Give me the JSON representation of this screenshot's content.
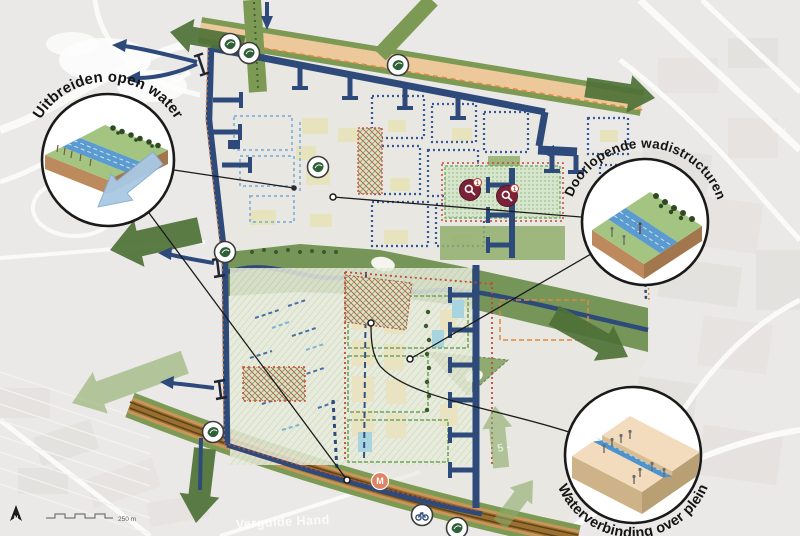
{
  "callouts": [
    {
      "id": "uitbreiden-open-water",
      "label": "Uitbreiden open water"
    },
    {
      "id": "doorlopende-wadistructuren",
      "label": "Doorlopende wadistructuren"
    },
    {
      "id": "waterverbinding-over-plein",
      "label": "Waterverbinding over plein"
    }
  ],
  "map": {
    "markers": [
      {
        "type": "water-icon",
        "x": 230,
        "y": 44
      },
      {
        "type": "water-icon",
        "x": 249,
        "y": 53
      },
      {
        "type": "water-icon",
        "x": 398,
        "y": 65
      },
      {
        "type": "water-icon",
        "x": 318,
        "y": 167
      },
      {
        "type": "water-icon",
        "x": 225,
        "y": 252
      },
      {
        "type": "water-icon",
        "x": 213,
        "y": 432
      },
      {
        "type": "water-icon",
        "x": 457,
        "y": 528
      },
      {
        "type": "transit-icon",
        "x": 422,
        "y": 515
      },
      {
        "type": "metro-station",
        "x": 380,
        "y": 481,
        "label": "M"
      },
      {
        "type": "attention",
        "x": 470,
        "y": 190,
        "badge": "1"
      },
      {
        "type": "attention",
        "x": 507,
        "y": 196,
        "badge": "1"
      }
    ],
    "leader_lines": [
      {
        "from": [
          174,
          170
        ],
        "to": [
          294,
          188
        ],
        "end": "filled"
      },
      {
        "from": [
          149,
          213
        ],
        "to": [
          347,
          480
        ],
        "end": "ring"
      },
      {
        "from": [
          581,
          217
        ],
        "to": [
          333,
          197
        ],
        "end": "ring"
      },
      {
        "from": [
          591,
          254
        ],
        "to": [
          410,
          359
        ],
        "end": "ring"
      },
      {
        "path": "M 569 432 C 495 408 408 398 380 366 C 372 355 371 340 371 326",
        "to": [
          371,
          323
        ],
        "end": "ring"
      }
    ],
    "basemap_labels": [
      {
        "id": "vergulde-hand",
        "text": "Vergulde Hand"
      },
      {
        "id": "road-number",
        "text": "5 -"
      },
      {
        "id": "credit-frag",
        "text": "ear"
      }
    ],
    "scale_label": "250 m",
    "north_label": "N",
    "colors": {
      "dark_green": "#4e7137",
      "light_green": "#8aab67",
      "navy": "#2e4a7a",
      "water_blue": "#5b9bd0",
      "tan_band": "#ecc89a",
      "road_brown": "#9a7030",
      "boundary_orange": "#e08840",
      "boundary_red": "#c24a33",
      "attention_maroon": "#7a2238",
      "marker_green": "#2f5f38",
      "callout_ink": "#1a1a1a"
    }
  }
}
